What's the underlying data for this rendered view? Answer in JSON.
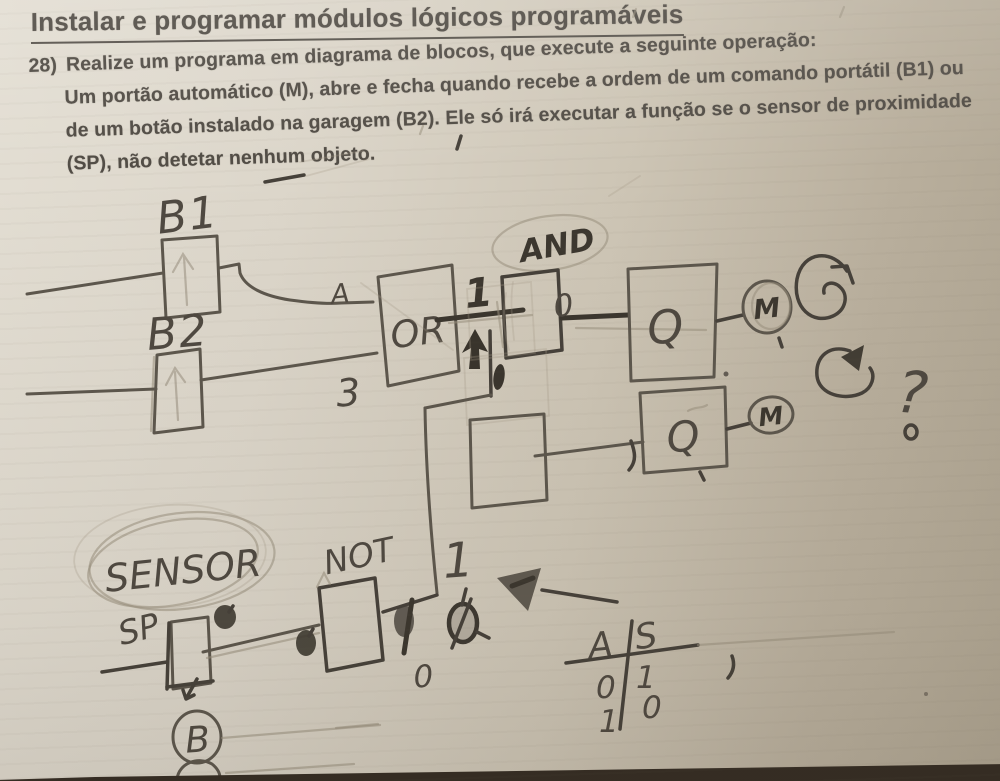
{
  "header": {
    "title": "Instalar e programar módulos lógicos programáveis"
  },
  "question": {
    "number": "28)",
    "line1": "Realize um programa em diagrama de blocos, que execute a seguinte operação:",
    "line2": "Um portão automático (M), abre e fecha quando recebe a ordem de um comando portátil (B1) ou",
    "line3": "de um botão instalado na garagem (B2). Ele só irá executar a função se o sensor de proximidade",
    "line4": "(SP), não detetar nenhum objeto."
  },
  "diagram": {
    "b1_label": "B1",
    "b2_label": "B2",
    "input_a_label": "A",
    "input_b_label": "3",
    "or_label": "OR",
    "and_label": "AND",
    "wire_one_label": "1",
    "and_output_label": "0",
    "q1_label": "Q",
    "m1_label": "M",
    "q2_label": "Q",
    "m2_label": "M",
    "question_mark": "?",
    "not_label": "NOT",
    "sensor_label": "SENSOR",
    "sp_label": "SP",
    "branch_one_label": "1",
    "not_output_zero_label": "0",
    "truth_table": {
      "col_a": "A",
      "col_s": "S",
      "row1_a": "0",
      "row1_s": "1",
      "row2_a": "1",
      "row2_s": "0"
    },
    "b_circle_label": "B"
  }
}
